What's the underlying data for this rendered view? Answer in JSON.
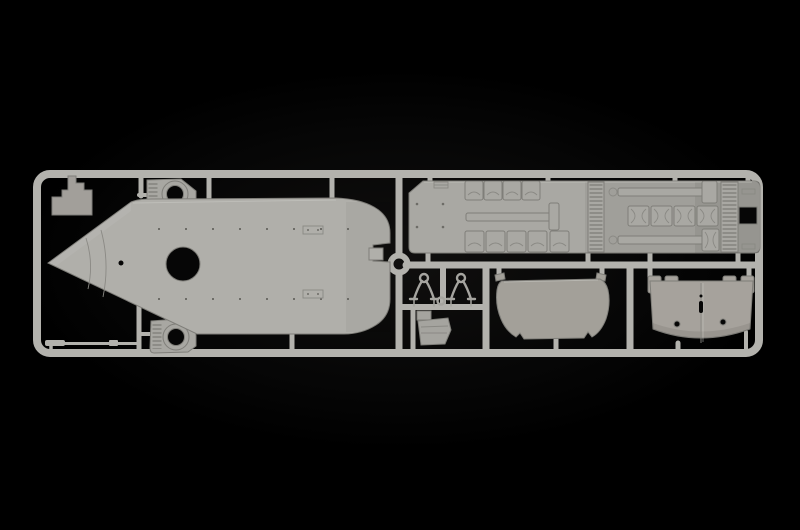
{
  "scene": {
    "subject": "plastic model kit sprue photographed on black background",
    "background_color": "#000000"
  },
  "colors": {
    "runner": "#b3b2ad",
    "hull": "#b0afaa",
    "deck": "#a9a8a3",
    "plate": "#a29f9a",
    "housing": "#a8a7a2",
    "windshield": "#a3a099",
    "transom": "#a6a29c",
    "small": "#a5a49f",
    "hole": "#060606",
    "rivet": "#6d6c67"
  },
  "parts": [
    "runner-frame",
    "ring-connector",
    "corner-plate",
    "blower-housing-top",
    "blower-housing-bottom",
    "hull-deck",
    "mast-rod",
    "cabin-deck",
    "davit-left",
    "davit-right",
    "towing-eyelet",
    "pump-fitting",
    "windshield-panel",
    "transom-panel"
  ]
}
